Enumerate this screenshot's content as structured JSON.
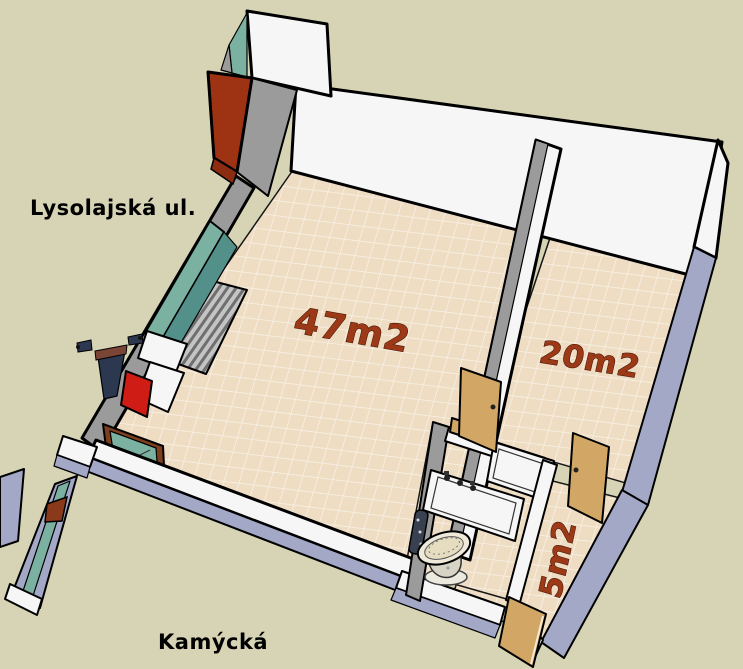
{
  "scene": {
    "street_top": "Lysolajská ul.",
    "street_bottom": "Kamýcká",
    "rooms": [
      {
        "name": "main room",
        "area_label": "47m2"
      },
      {
        "name": "back room",
        "area_label": "20m2"
      },
      {
        "name": "hallway",
        "area_label": "5m2"
      }
    ],
    "objects": [
      "storefront-glazing",
      "radiator",
      "chimney",
      "entrance-door",
      "interior-doors",
      "bathtub",
      "toilet",
      "person-figure",
      "exterior-ramp"
    ],
    "palette": {
      "background": "#d6d4b5",
      "floor_tile": "#eedcc3",
      "floor_grout": "#f8f1e4",
      "wall_white": "#f6f6f6",
      "wall_gray": "#9b9b9b",
      "wall_gray_dark": "#757575",
      "exterior": "#a3a8c6",
      "glass": "#7bb1a1",
      "glass_dark": "#53908a",
      "label_red": "#9c3917",
      "wall_red": "#9e3314",
      "door_red": "#cf1d15",
      "wood": "#d2a765",
      "wood_dark": "#7e3f1f",
      "navy": "#2c3850",
      "outline": "#000000",
      "text": "#000000"
    }
  }
}
